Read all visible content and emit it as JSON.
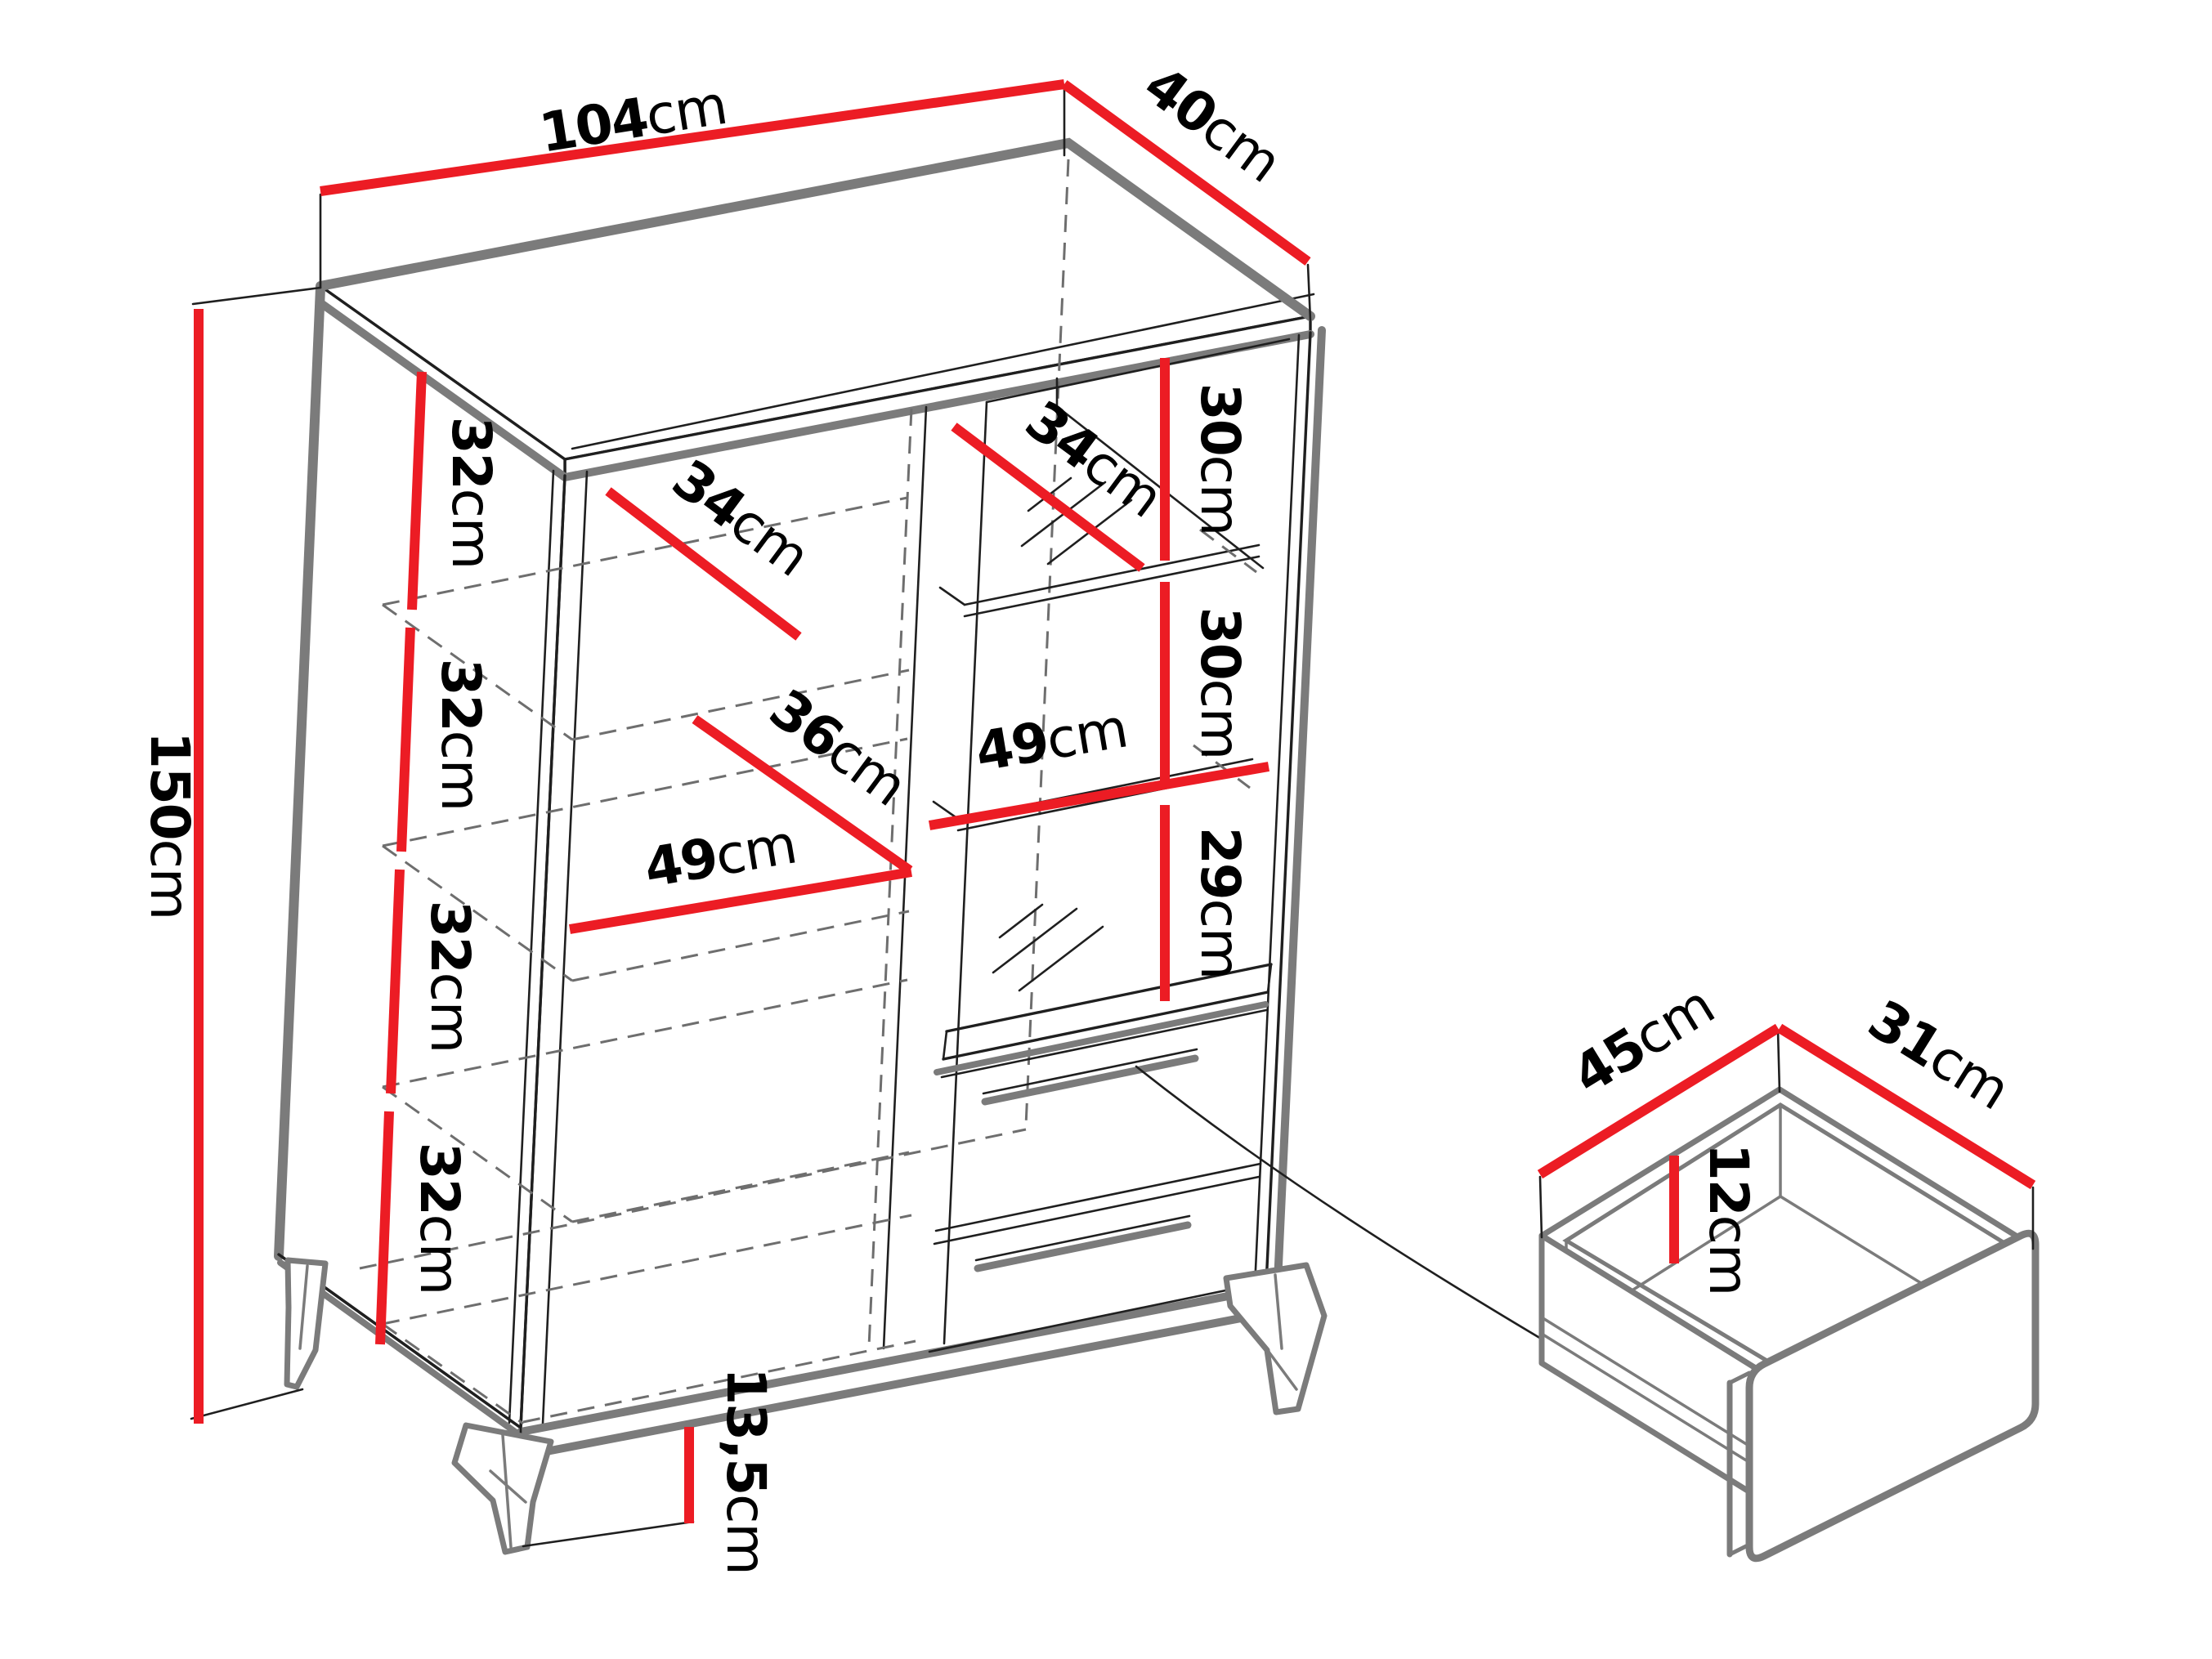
{
  "drawing": {
    "type": "furniture-dimension-diagram",
    "subject": "display cabinet with glass door, shelves, two drawers and angled legs, plus open-drawer inset detail",
    "colors": {
      "dimension_red": "#ec1c24",
      "outline_black": "#1f1f1f",
      "accent_gray": "#7b7b7b",
      "dashed_gray": "#6e6e6e",
      "background": "#ffffff"
    }
  },
  "dims": {
    "width": "104cm",
    "depth": "40cm",
    "height": "150cm",
    "gap1": "32cm",
    "gap2": "32cm",
    "gap3": "32cm",
    "gap4": "32cm",
    "shelf_depth_top": "34cm",
    "shelf_depth_mid": "36cm",
    "shelf_width_left": "49cm",
    "glass_shelf_depth": "34cm",
    "glass_gap1": "30cm",
    "glass_gap2": "30cm",
    "glass_gap3": "29cm",
    "shelf_width_right": "49cm",
    "leg_height": "13,5cm",
    "drawer_depth": "45cm",
    "drawer_width": "31cm",
    "drawer_inner_height": "12cm"
  }
}
